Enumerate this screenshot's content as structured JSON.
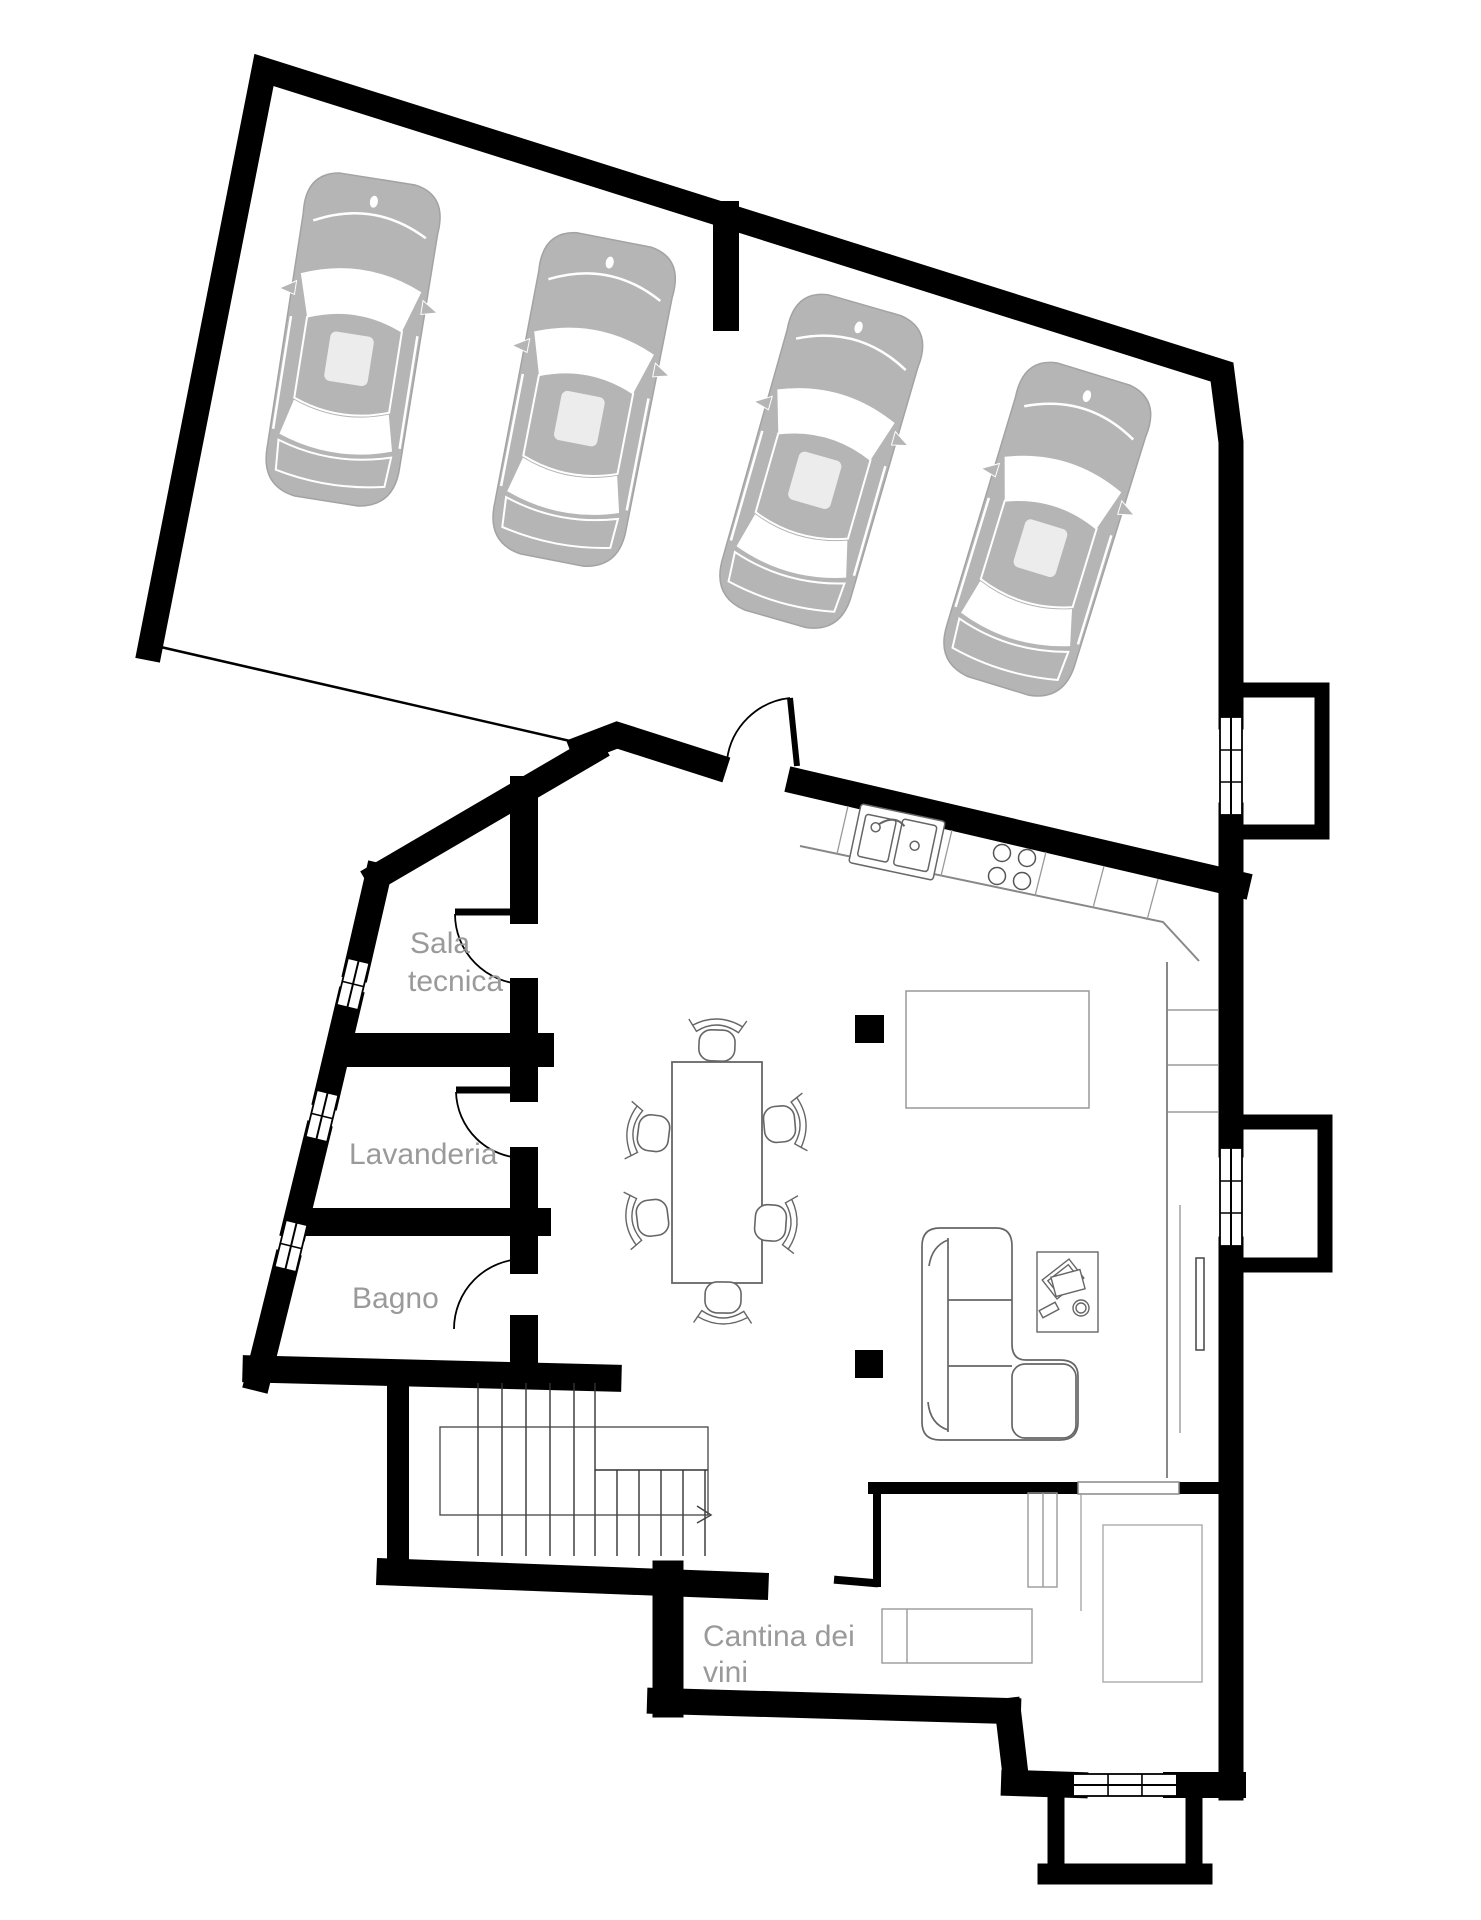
{
  "plan": {
    "labels": {
      "sala_tecnica_line1": "Sala",
      "sala_tecnica_line2": "tecnica",
      "lavanderia": "Lavanderia",
      "bagno": "Bagno",
      "cantina_line1": "Cantina dei",
      "cantina_line2": "vini"
    },
    "colors": {
      "wall": "#000000",
      "label_text": "#9a9a9a",
      "car_body": "#b5b5b5",
      "furniture_line": "#666666",
      "light_line": "#999999"
    },
    "garage": {
      "car_count": "4"
    }
  }
}
